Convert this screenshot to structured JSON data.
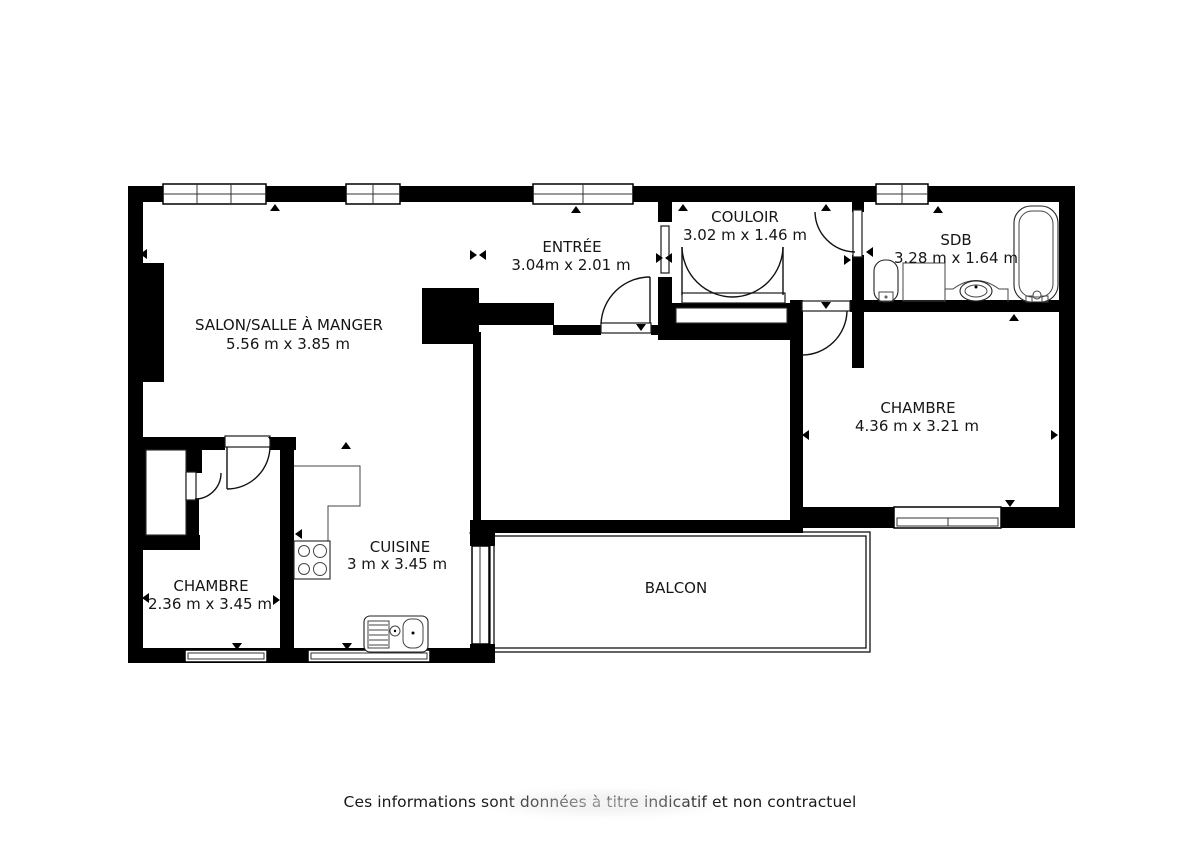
{
  "title": "Plan d'appartement",
  "rooms": [
    {
      "name": "SALON/SALLE À MANGER",
      "dimensions": "5.56 m x 3.85 m"
    },
    {
      "name": "ENTRÉE",
      "dimensions": "3.04m x 2.01 m"
    },
    {
      "name": "COULOIR",
      "dimensions": "3.02 m x 1.46 m"
    },
    {
      "name": "SDB",
      "dimensions": "3.28 m x 1.64 m"
    },
    {
      "name": "CHAMBRE",
      "dimensions": "4.36 m x 3.21 m"
    },
    {
      "name": "CHAMBRE",
      "dimensions": "2.36 m x 3.45 m"
    },
    {
      "name": "CUISINE",
      "dimensions": "3 m x 3.45 m"
    },
    {
      "name": "BALCON",
      "dimensions": ""
    }
  ],
  "footer": {
    "disclaimer": "Ces informations sont données à titre indicatif et non contractuel"
  },
  "colors": {
    "wall": "#000000",
    "background": "#ffffff",
    "text": "#151515"
  }
}
